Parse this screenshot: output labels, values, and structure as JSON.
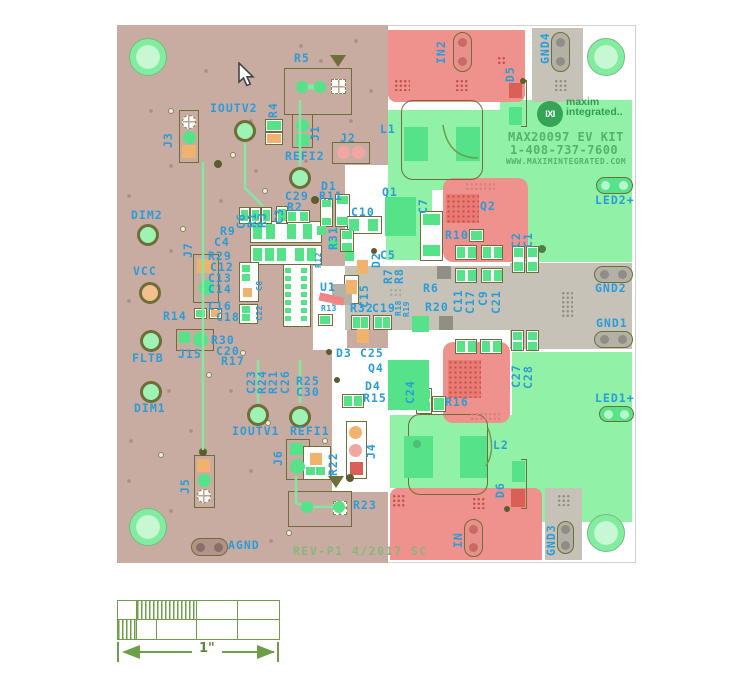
{
  "title_block": {
    "logo_glyph": "IXI",
    "brand_top": "maxim",
    "brand_bottom": "integrated..",
    "line1": "MAX20097 EV KIT",
    "line2": "1-408-737-7600",
    "line3": "WWW.MAXIMINTEGRATED.COM"
  },
  "rev_text": "REV-P1 4/2017 SC",
  "scale_bar": {
    "label": "1\""
  },
  "colors": {
    "board_substrate": "#c8aca1",
    "copper_green_zone": "#90f1a7",
    "copper_red_zone": "#ef918c",
    "copper_gray_zone": "#c6c2b8",
    "pad_green": "#55e288",
    "pad_orange": "#f0b36e",
    "pad_pink": "#f2a6a2",
    "silkscreen_blue": "#2b9cd8",
    "outline_olive": "#6f6d38",
    "brand_green": "#2f9e4f",
    "text_green": "#55b36a",
    "rev_green": "#8ab57e",
    "scale_green": "#6f9e4a"
  },
  "silkscreen_labels": [
    {
      "t": "R5",
      "x": 294,
      "y": 53
    },
    {
      "t": "IOUTV2",
      "x": 210,
      "y": 103
    },
    {
      "t": "REFI2",
      "x": 285,
      "y": 151
    },
    {
      "t": "J2",
      "x": 340,
      "y": 133
    },
    {
      "t": "D1",
      "x": 321,
      "y": 181
    },
    {
      "t": "R11",
      "x": 319,
      "y": 191
    },
    {
      "t": "C29",
      "x": 285,
      "y": 191
    },
    {
      "t": "R2",
      "x": 287,
      "y": 202
    },
    {
      "t": "C10",
      "x": 351,
      "y": 207
    },
    {
      "t": "Q1",
      "x": 382,
      "y": 187
    },
    {
      "t": "Q2",
      "x": 480,
      "y": 201
    },
    {
      "t": "R10",
      "x": 445,
      "y": 230
    },
    {
      "t": "C5",
      "x": 380,
      "y": 250
    },
    {
      "t": "R6",
      "x": 423,
      "y": 283
    },
    {
      "t": "R20",
      "x": 425,
      "y": 302
    },
    {
      "t": "R9",
      "x": 220,
      "y": 226
    },
    {
      "t": "C4",
      "x": 214,
      "y": 237
    },
    {
      "t": "R29",
      "x": 208,
      "y": 251
    },
    {
      "t": "C12",
      "x": 210,
      "y": 262
    },
    {
      "t": "C13",
      "x": 208,
      "y": 273
    },
    {
      "t": "C14",
      "x": 208,
      "y": 284
    },
    {
      "t": "C16",
      "x": 208,
      "y": 301
    },
    {
      "t": "C18",
      "x": 216,
      "y": 312
    },
    {
      "t": "U1",
      "x": 320,
      "y": 282
    },
    {
      "t": "R13",
      "x": 321,
      "y": 305,
      "s": 1
    },
    {
      "t": "R32",
      "x": 350,
      "y": 303
    },
    {
      "t": "C19",
      "x": 372,
      "y": 303
    },
    {
      "t": "D3",
      "x": 336,
      "y": 348
    },
    {
      "t": "C25",
      "x": 360,
      "y": 348
    },
    {
      "t": "Q4",
      "x": 368,
      "y": 363
    },
    {
      "t": "D4",
      "x": 365,
      "y": 381
    },
    {
      "t": "R15",
      "x": 363,
      "y": 393
    },
    {
      "t": "R16",
      "x": 445,
      "y": 397
    },
    {
      "t": "R25",
      "x": 296,
      "y": 376
    },
    {
      "t": "C30",
      "x": 296,
      "y": 387
    },
    {
      "t": "R30",
      "x": 211,
      "y": 335
    },
    {
      "t": "C20",
      "x": 216,
      "y": 346
    },
    {
      "t": "R17",
      "x": 221,
      "y": 356
    },
    {
      "t": "R14",
      "x": 163,
      "y": 311
    },
    {
      "t": "J15",
      "x": 178,
      "y": 349
    },
    {
      "t": "DIM2",
      "x": 131,
      "y": 210
    },
    {
      "t": "VCC",
      "x": 133,
      "y": 266
    },
    {
      "t": "FLTB",
      "x": 132,
      "y": 353
    },
    {
      "t": "DIM1",
      "x": 134,
      "y": 403
    },
    {
      "t": "IOUTV1",
      "x": 232,
      "y": 426
    },
    {
      "t": "REFI1",
      "x": 290,
      "y": 426
    },
    {
      "t": "AGND",
      "x": 228,
      "y": 540
    },
    {
      "t": "R23",
      "x": 353,
      "y": 500
    },
    {
      "t": "L2",
      "x": 493,
      "y": 440
    },
    {
      "t": "L1",
      "x": 380,
      "y": 124
    },
    {
      "t": "LED2+",
      "x": 595,
      "y": 195
    },
    {
      "t": "GND2",
      "x": 595,
      "y": 283
    },
    {
      "t": "GND1",
      "x": 596,
      "y": 318
    },
    {
      "t": "LED1+",
      "x": 595,
      "y": 393
    },
    {
      "t": "J3",
      "x": 163,
      "y": 148,
      "v": 1
    },
    {
      "t": "R4",
      "x": 268,
      "y": 118,
      "v": 1
    },
    {
      "t": "J1",
      "x": 310,
      "y": 141,
      "v": 1
    },
    {
      "t": "IN2",
      "x": 436,
      "y": 64,
      "v": 1
    },
    {
      "t": "D5",
      "x": 505,
      "y": 82,
      "v": 1
    },
    {
      "t": "GND4",
      "x": 540,
      "y": 64,
      "v": 1
    },
    {
      "t": "J7",
      "x": 183,
      "y": 258,
      "v": 1
    },
    {
      "t": "C6",
      "x": 236,
      "y": 229,
      "v": 1
    },
    {
      "t": "R1",
      "x": 247,
      "y": 228,
      "v": 1
    },
    {
      "t": "R3",
      "x": 257,
      "y": 228,
      "v": 1
    },
    {
      "t": "C3",
      "x": 274,
      "y": 224,
      "v": 1
    },
    {
      "t": "R31",
      "x": 328,
      "y": 250,
      "v": 1
    },
    {
      "t": "R12",
      "x": 315,
      "y": 268,
      "v": 1,
      "s": 1
    },
    {
      "t": "C8",
      "x": 256,
      "y": 291,
      "v": 1,
      "s": 1
    },
    {
      "t": "C22",
      "x": 256,
      "y": 321,
      "v": 1,
      "s": 1
    },
    {
      "t": "C15",
      "x": 359,
      "y": 308,
      "v": 1
    },
    {
      "t": "D2",
      "x": 371,
      "y": 268,
      "v": 1
    },
    {
      "t": "R7",
      "x": 383,
      "y": 284,
      "v": 1
    },
    {
      "t": "R8",
      "x": 394,
      "y": 284,
      "v": 1
    },
    {
      "t": "C7",
      "x": 418,
      "y": 214,
      "v": 1
    },
    {
      "t": "C2",
      "x": 511,
      "y": 248,
      "v": 1
    },
    {
      "t": "C1",
      "x": 523,
      "y": 248,
      "v": 1
    },
    {
      "t": "C11",
      "x": 453,
      "y": 313,
      "v": 1
    },
    {
      "t": "C17",
      "x": 465,
      "y": 314,
      "v": 1
    },
    {
      "t": "C9",
      "x": 478,
      "y": 306,
      "v": 1
    },
    {
      "t": "C21",
      "x": 491,
      "y": 314,
      "v": 1
    },
    {
      "t": "R18",
      "x": 395,
      "y": 316,
      "v": 1,
      "s": 1
    },
    {
      "t": "R19",
      "x": 403,
      "y": 317,
      "v": 1,
      "s": 1
    },
    {
      "t": "C23",
      "x": 246,
      "y": 394,
      "v": 1
    },
    {
      "t": "R24",
      "x": 257,
      "y": 394,
      "v": 1
    },
    {
      "t": "R21",
      "x": 268,
      "y": 394,
      "v": 1
    },
    {
      "t": "C26",
      "x": 280,
      "y": 394,
      "v": 1
    },
    {
      "t": "C24",
      "x": 405,
      "y": 404,
      "v": 1
    },
    {
      "t": "C27",
      "x": 511,
      "y": 388,
      "v": 1
    },
    {
      "t": "C28",
      "x": 523,
      "y": 389,
      "v": 1
    },
    {
      "t": "J6",
      "x": 273,
      "y": 466,
      "v": 1
    },
    {
      "t": "R22",
      "x": 328,
      "y": 476,
      "v": 1
    },
    {
      "t": "J4",
      "x": 366,
      "y": 459,
      "v": 1
    },
    {
      "t": "J5",
      "x": 180,
      "y": 494,
      "v": 1
    },
    {
      "t": "D6",
      "x": 495,
      "y": 498,
      "v": 1
    },
    {
      "t": "IN",
      "x": 453,
      "y": 548,
      "v": 1
    },
    {
      "t": "GND3",
      "x": 546,
      "y": 556,
      "v": 1
    }
  ]
}
